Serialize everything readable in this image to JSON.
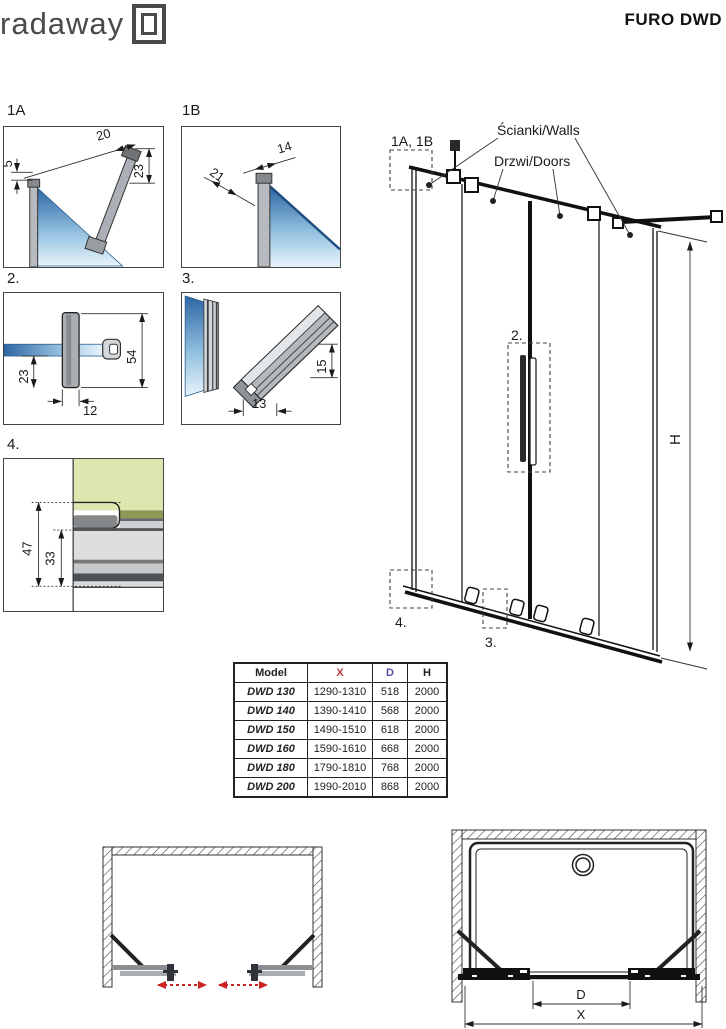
{
  "header": {
    "logo_text": "radaway",
    "title": "FURO DWD"
  },
  "details": {
    "d1a": {
      "label": "1A",
      "dims": [
        "20",
        "5",
        "23"
      ]
    },
    "d1b": {
      "label": "1B",
      "dims": [
        "14",
        "21"
      ]
    },
    "d2": {
      "label": "2.",
      "dims": [
        "23",
        "12",
        "54"
      ]
    },
    "d3": {
      "label": "3.",
      "dims": [
        "13",
        "15"
      ]
    },
    "d4": {
      "label": "4.",
      "dims": [
        "47",
        "33"
      ]
    }
  },
  "elevation": {
    "callouts": {
      "c1ab": "1A, 1B",
      "c2": "2.",
      "c3": "3.",
      "c4": "4."
    },
    "labels": {
      "walls": "Ścianki/Walls",
      "doors": "Drzwi/Doors",
      "height": "H"
    }
  },
  "spec_table": {
    "headers": [
      "Model",
      "X",
      "D",
      "H"
    ],
    "rows": [
      [
        "DWD 130",
        "1290-1310",
        "518",
        "2000"
      ],
      [
        "DWD 140",
        "1390-1410",
        "568",
        "2000"
      ],
      [
        "DWD 150",
        "1490-1510",
        "618",
        "2000"
      ],
      [
        "DWD 160",
        "1590-1610",
        "668",
        "2000"
      ],
      [
        "DWD 180",
        "1790-1810",
        "768",
        "2000"
      ],
      [
        "DWD 200",
        "1990-2010",
        "868",
        "2000"
      ]
    ]
  },
  "plan": {
    "dim_d": "D",
    "dim_x": "X"
  },
  "colors": {
    "dim_red": "#b43c3c",
    "dim_purple": "#55509b",
    "glass_blue": "#2e66a4",
    "glass_green": "#dce7b0"
  }
}
